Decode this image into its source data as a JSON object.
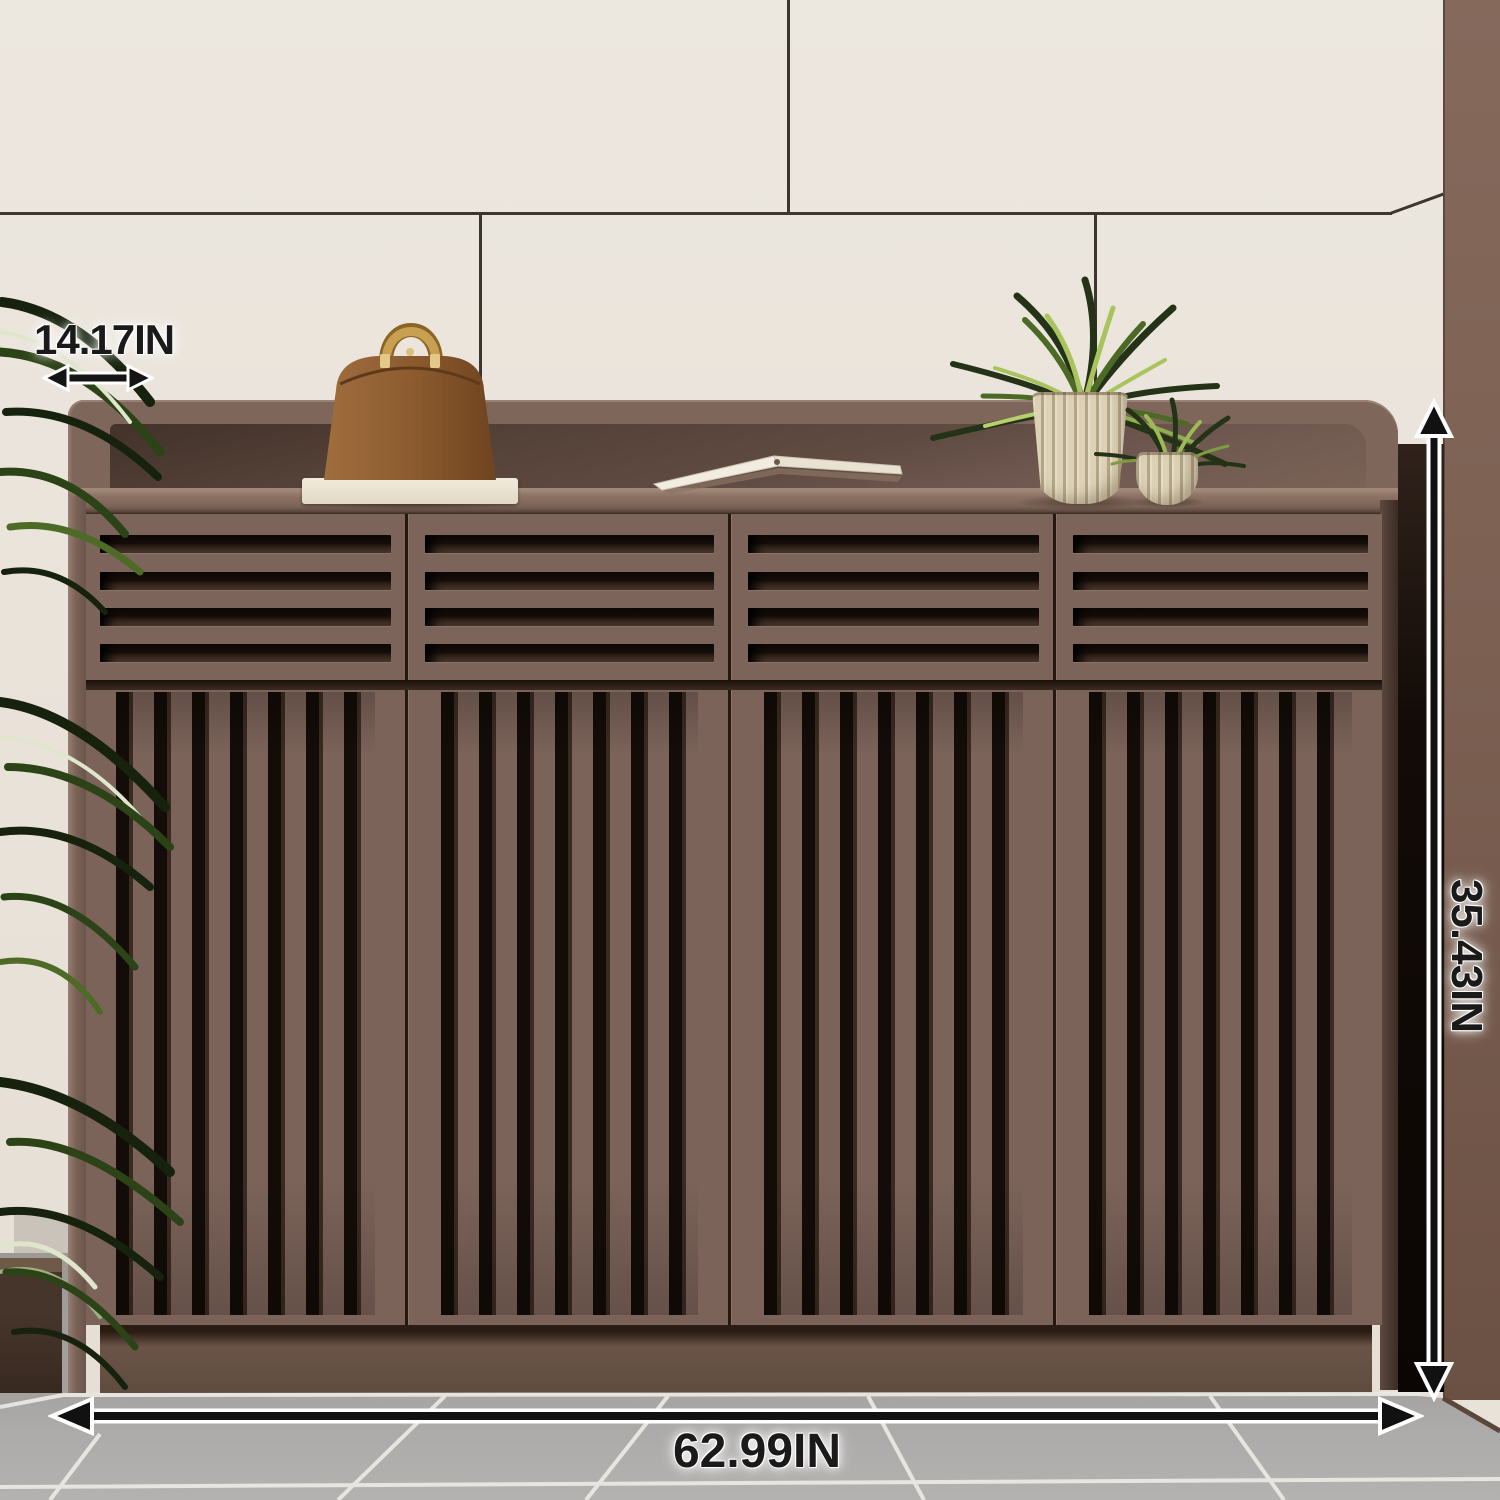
{
  "annotations": {
    "depth_label": "14.17IN",
    "height_label": "35.43IN",
    "width_label": "62.99IN"
  },
  "scene": {
    "setting": "entryway with cream tiled wall, brown wall pillar and gray tile floor",
    "furniture": "brown louvered shoe cabinet with 4 slotted drawers, 4 vertical-slat doors and recessed plinth",
    "decor": [
      "brown handbag with gold handle on white slab",
      "open book lying on cabinet top",
      "large spider plant in ribbed cream vase",
      "small spider plant in ribbed cream pot",
      "tall green floor plant at left",
      "dark wood planter box at bottom left"
    ],
    "colors": {
      "cabinet": "#7c645a",
      "cabinet_slot_shadow": "#130c08",
      "wall": "#eae3da",
      "pillar": "#7c6153",
      "floor": "#abaaa7",
      "annotation_text": "#1a1a1a",
      "annotation_outline": "#ffffff",
      "handbag": "#96663a",
      "handle_gold": "#c9a051",
      "plant_green": "#6f9038",
      "pot_cream": "#ddd2b6"
    }
  }
}
